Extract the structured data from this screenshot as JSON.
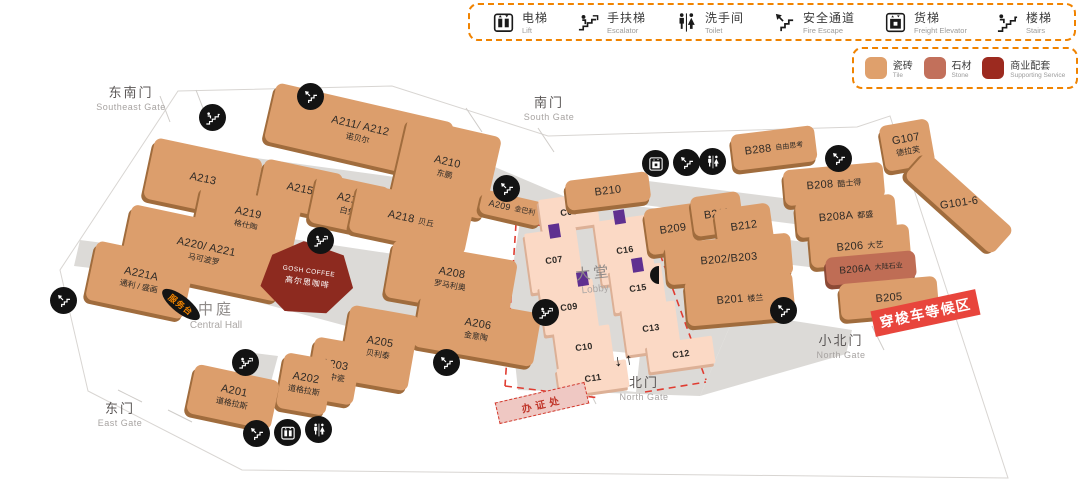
{
  "legend": {
    "items": [
      {
        "icon": "lift-icon",
        "zh": "电梯",
        "en": "Lift"
      },
      {
        "icon": "escalator-icon",
        "zh": "手扶梯",
        "en": "Escalator"
      },
      {
        "icon": "toilet-icon",
        "zh": "洗手间",
        "en": "Toilet"
      },
      {
        "icon": "fire-escape-icon",
        "zh": "安全通道",
        "en": "Fire Escape"
      },
      {
        "icon": "freight-elevator-icon",
        "zh": "货梯",
        "en": "Freight Elevator"
      },
      {
        "icon": "stairs-icon",
        "zh": "楼梯",
        "en": "Stairs"
      }
    ]
  },
  "materials": {
    "items": [
      {
        "zh": "瓷砖",
        "en": "Tile",
        "color": "#DFA06C"
      },
      {
        "zh": "石材",
        "en": "Stone",
        "color": "#C2705B"
      },
      {
        "zh": "商业配套",
        "en": "Supporting Service",
        "color": "#9C2A1F"
      }
    ]
  },
  "gates": {
    "southeast": {
      "zh": "东南门",
      "en": "Southeast Gate"
    },
    "south": {
      "zh": "南门",
      "en": "South Gate"
    },
    "east": {
      "zh": "东门",
      "en": "East Gate"
    },
    "north": {
      "zh": "北门",
      "en": "North Gate"
    },
    "north_small": {
      "zh": "小北门",
      "en": "North Gate"
    }
  },
  "areas": {
    "central_hall": {
      "zh": "中庭",
      "en": "Central Hall"
    },
    "lobby": {
      "zh": "大堂",
      "en": "Lobby"
    },
    "service_desk": "服务台",
    "shuttle_zone": "穿梭车等候区",
    "registration": "办证处",
    "coffee": {
      "line1": "GOSH COFFEE",
      "line2": "高尔思咖啡"
    }
  },
  "misc": {
    "north_arrows": "↓↑"
  },
  "booths": {
    "a211": {
      "id": "A211/ A212",
      "name": "诺贝尔"
    },
    "a210": {
      "id": "A210",
      "name": "东鹏"
    },
    "a213": {
      "id": "A213"
    },
    "a215": {
      "id": "A215"
    },
    "a216": {
      "id": "A216",
      "name": "白兔"
    },
    "a218": {
      "id": "A218",
      "name": "贝丘"
    },
    "a219": {
      "id": "A219",
      "name": "格仕陶"
    },
    "a220": {
      "id": "A220/ A221",
      "name": "马可波罗"
    },
    "a221a": {
      "id": "A221A",
      "name": "通利 / 盛画"
    },
    "a209": {
      "id": "A209",
      "name": "金巴利"
    },
    "a208": {
      "id": "A208",
      "name": "罗马利奥"
    },
    "a206": {
      "id": "A206",
      "name": "金意陶"
    },
    "a205": {
      "id": "A205",
      "name": "贝利泰"
    },
    "a203": {
      "id": "A203",
      "name": "新中瓷"
    },
    "a202": {
      "id": "A202",
      "name": "道格拉斯"
    },
    "a201": {
      "id": "A201",
      "name": "道格拉斯"
    },
    "b210": {
      "id": "B210"
    },
    "b209": {
      "id": "B209"
    },
    "b211": {
      "id": "B211"
    },
    "b212": {
      "id": "B212"
    },
    "b202": {
      "id": "B202/B203"
    },
    "b201": {
      "id": "B201",
      "name": "楼兰"
    },
    "b288": {
      "id": "B288",
      "name": "自由思考"
    },
    "b208": {
      "id": "B208",
      "name": "酷士得"
    },
    "b208a": {
      "id": "B208A",
      "name": "都盛"
    },
    "b206": {
      "id": "B206",
      "name": "大艺"
    },
    "b206a": {
      "id": "B206A",
      "name": "大陆石业"
    },
    "b205": {
      "id": "B205"
    },
    "g107": {
      "id": "G107",
      "name": "德拉芙"
    },
    "g101": {
      "id": "G101-6"
    },
    "c06": {
      "id": "C06"
    },
    "c07": {
      "id": "C07"
    },
    "c09": {
      "id": "C09"
    },
    "c10": {
      "id": "C10"
    },
    "c11": {
      "id": "C11"
    },
    "c16": {
      "id": "C16"
    },
    "c15": {
      "id": "C15"
    },
    "c13": {
      "id": "C13"
    },
    "c12": {
      "id": "C12"
    }
  }
}
